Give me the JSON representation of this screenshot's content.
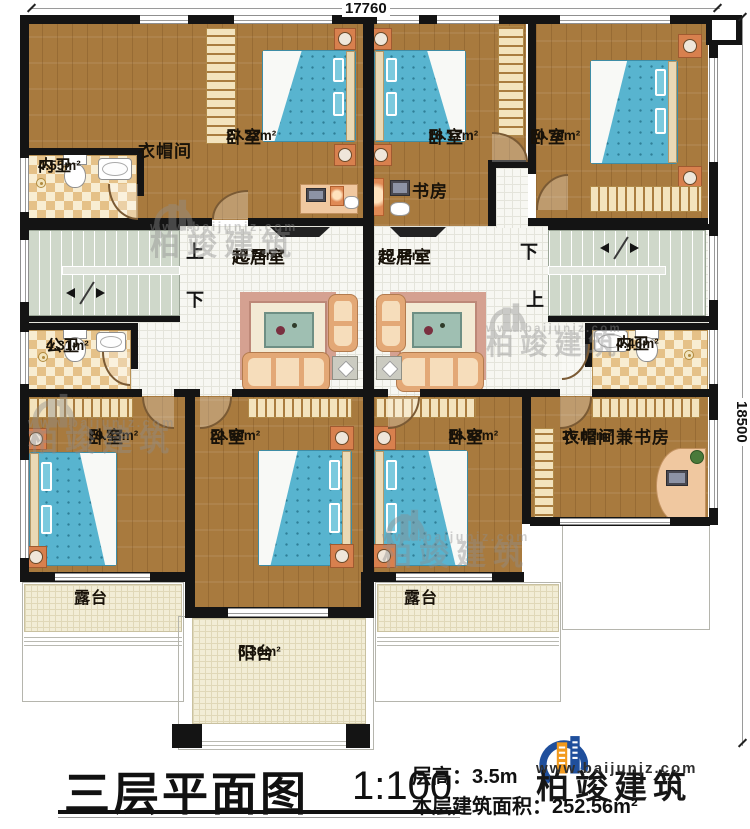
{
  "dims": {
    "top": "17760",
    "right": "18500"
  },
  "stairs": {
    "up": "上",
    "down": "下"
  },
  "rooms": {
    "ensuite_tl": {
      "name": "内卫",
      "area": "4.55m²"
    },
    "cloakroom": {
      "name": "衣帽间",
      "area": ""
    },
    "bedroom_tl": {
      "name": "卧室",
      "area": "27.22m²"
    },
    "bedroom_tm": {
      "name": "卧室",
      "area": "18.17m²"
    },
    "study": {
      "name": "书房",
      "area": ""
    },
    "bedroom_tr": {
      "name": "卧室",
      "area": "20.70m²"
    },
    "living_left": {
      "name": "起居室",
      "area": "30.76m²"
    },
    "living_right": {
      "name": "起居室",
      "area": "29.48m²"
    },
    "bath_public": {
      "name": "公卫",
      "area": "4.31m²"
    },
    "ensuite_r": {
      "name": "内卫",
      "area": "4.46m²"
    },
    "bedroom_bl": {
      "name": "卧室",
      "area": "19.43m²"
    },
    "bedroom_bm": {
      "name": "卧室",
      "area": "22.60m²"
    },
    "bedroom_br": {
      "name": "卧室",
      "area": "18.88m²"
    },
    "cloak_study": {
      "name": "衣帽间兼书房",
      "area": "16.62m²"
    },
    "terrace_left": {
      "name": "露台",
      "area": ""
    },
    "terrace_right": {
      "name": "露台",
      "area": ""
    },
    "balcony": {
      "name": "阳台",
      "area": "6.30m²"
    }
  },
  "titleblock": {
    "title": "三层平面图",
    "scale": "1:100",
    "floor_height": "层高：3.5m",
    "floor_area": "本层建筑面积：252.56m²"
  },
  "logo": {
    "brand": "柏竣建筑",
    "site": "www.baijunjz.com"
  },
  "watermark": {
    "brand": "柏竣建筑",
    "site": "www.baijunjz.com"
  },
  "colors": {
    "accent_blue": "#1f4f9c",
    "accent_orange": "#f29a1d",
    "wall": "#141414"
  }
}
